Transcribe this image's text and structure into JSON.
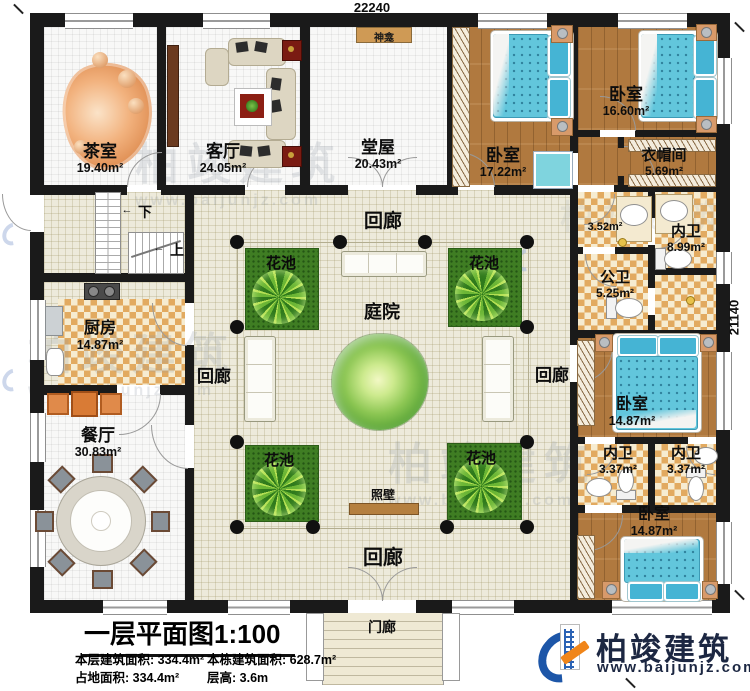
{
  "dimensions": {
    "top": "22240",
    "right": "21140"
  },
  "labels": {
    "corridor": "回廊",
    "flower_bed": "花池",
    "courtyard": "庭院",
    "screen_wall": "照壁",
    "porch": "门廊",
    "shrine": "神龛",
    "stair_up": "上",
    "stair_down": "下",
    "arrow": "←"
  },
  "rooms": {
    "tea_room": {
      "name": "茶室",
      "area": "19.40m²"
    },
    "living_room": {
      "name": "客厅",
      "area": "24.05m²"
    },
    "hall": {
      "name": "堂屋",
      "area": "20.43m²"
    },
    "bedroom_top_left": {
      "name": "卧室",
      "area": "17.22m²"
    },
    "bedroom_top_right": {
      "name": "卧室",
      "area": "16.60m²"
    },
    "cloakroom": {
      "name": "衣帽间",
      "area": "5.69m²"
    },
    "wash_area": {
      "area": "3.52m²"
    },
    "ensuite_main": {
      "name": "内卫",
      "area": "8.99m²"
    },
    "public_bath": {
      "name": "公卫",
      "area": "5.25m²"
    },
    "bedroom_mid": {
      "name": "卧室",
      "area": "14.87m²"
    },
    "ensuite_left": {
      "name": "内卫",
      "area": "3.37m²"
    },
    "ensuite_right": {
      "name": "内卫",
      "area": "3.37m²"
    },
    "bedroom_bottom": {
      "name": "卧室",
      "area": "14.87m²"
    },
    "kitchen": {
      "name": "厨房",
      "area": "14.87m²"
    },
    "dining_room": {
      "name": "餐厅",
      "area": "30.83m²"
    }
  },
  "title_block": {
    "title": "一层平面图1:100",
    "stats": [
      {
        "label": "本层建筑面积:",
        "value": "334.4m²"
      },
      {
        "label": "本栋建筑面积:",
        "value": "628.7m²"
      },
      {
        "label": "占地面积:",
        "value": "334.4m²"
      },
      {
        "label": "层高:",
        "value": "3.6m"
      }
    ]
  },
  "branding": {
    "company": "柏竣建筑",
    "website": "www.baijunjz.com",
    "brand_blue": "#1d56a8",
    "brand_orange": "#f08519"
  },
  "watermark": {
    "text": "柏竣建筑",
    "url": "www.baijunjz.com"
  }
}
